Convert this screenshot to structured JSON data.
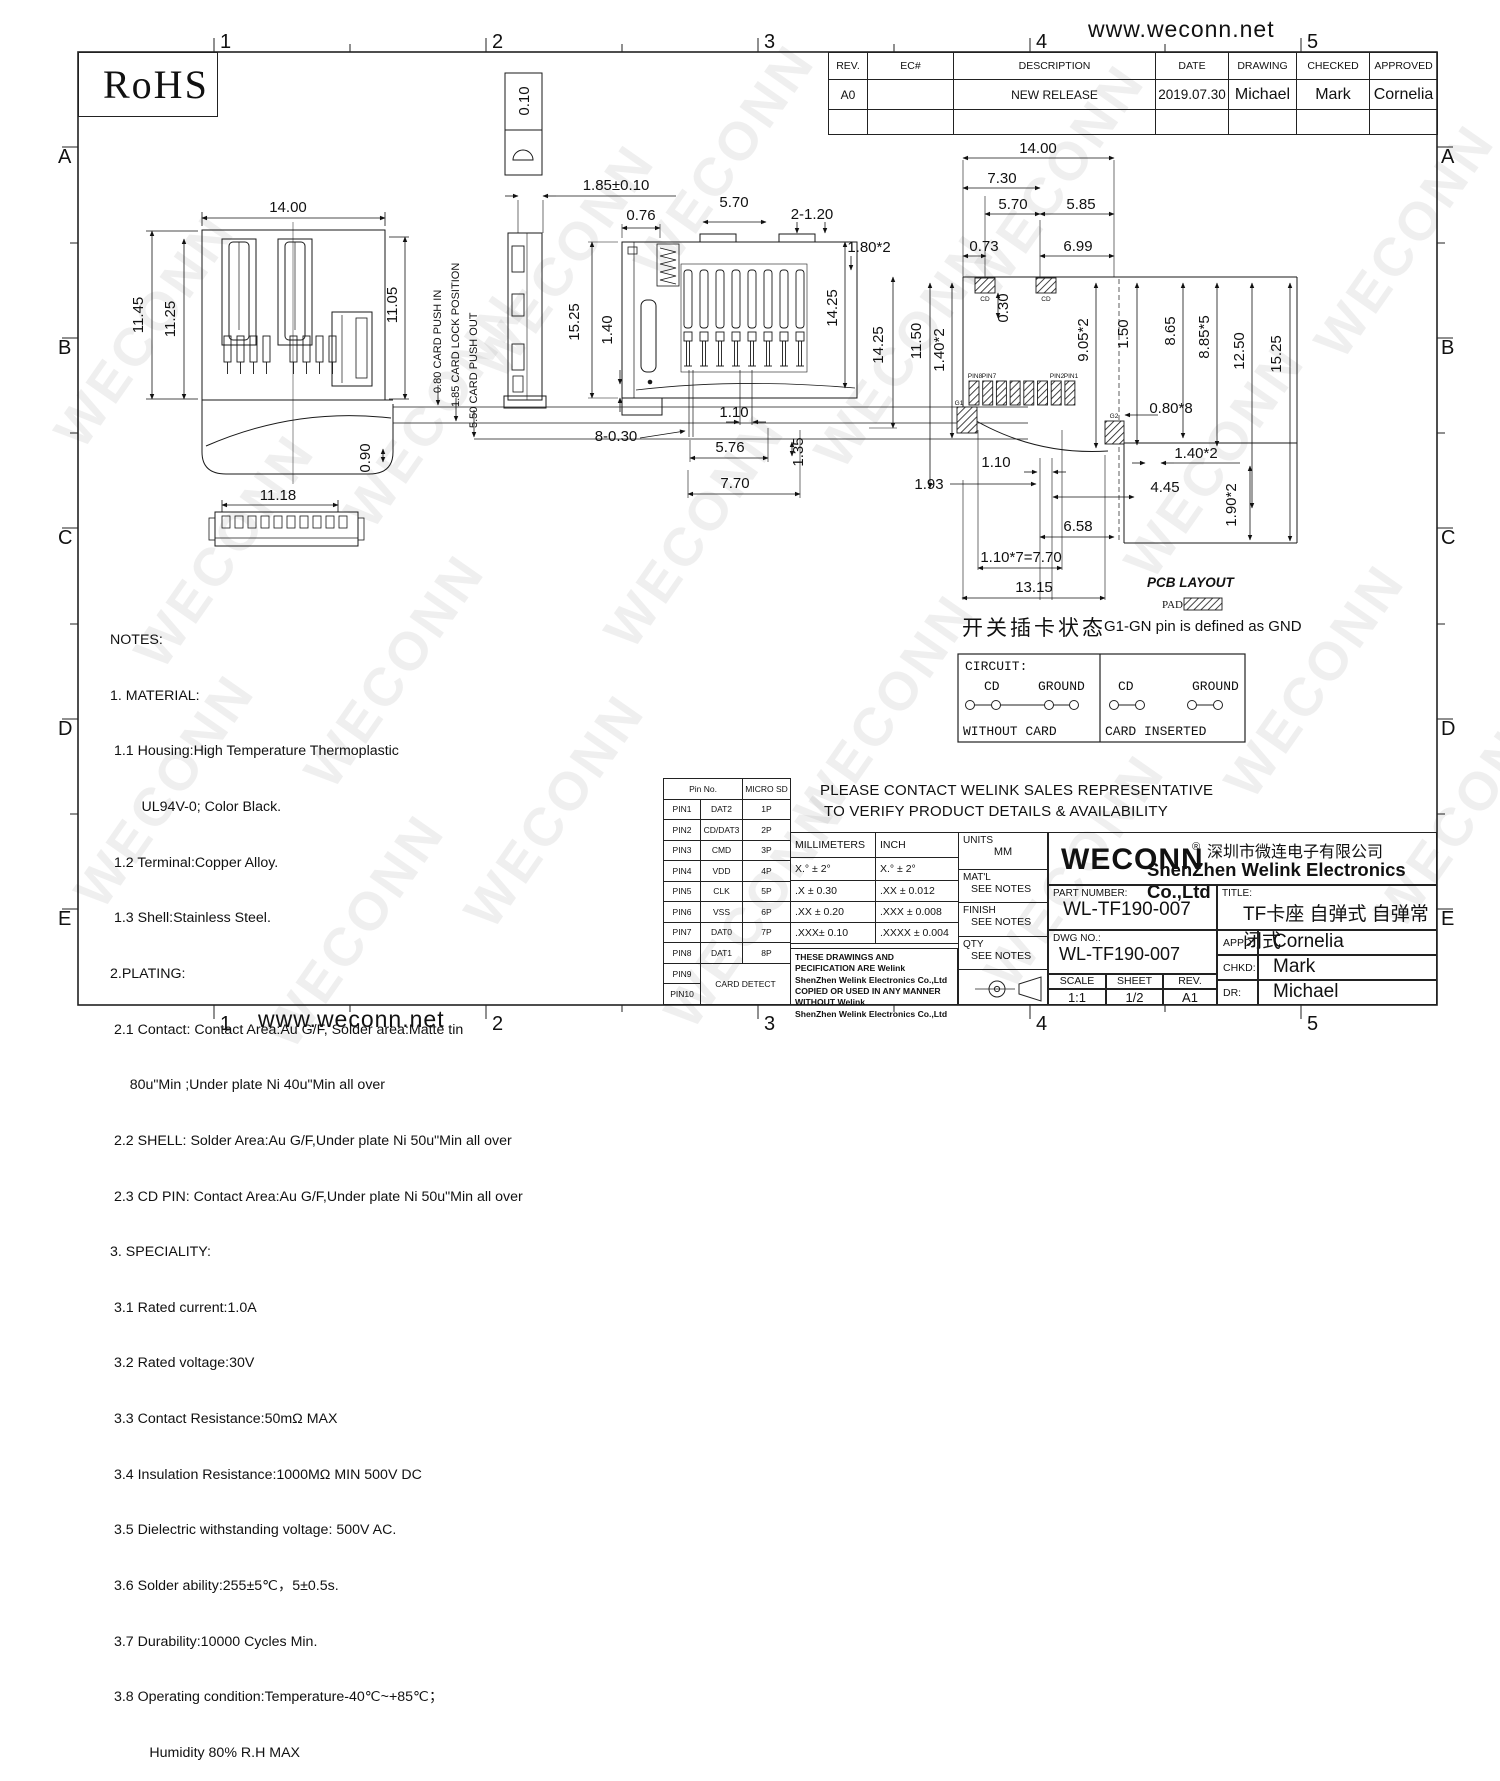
{
  "page": {
    "website_top": "www.weconn.net",
    "website_bottom": "www.weconn.net",
    "watermark": "WECONN"
  },
  "zones": {
    "cols": [
      "1",
      "2",
      "3",
      "4",
      "5"
    ],
    "rows": [
      "A",
      "B",
      "C",
      "D",
      "E"
    ]
  },
  "rohs": {
    "label": "RoHS"
  },
  "revision_table": {
    "headers": [
      "REV.",
      "EC#",
      "DESCRIPTION",
      "DATE",
      "DRAWING",
      "CHECKED",
      "APPROVED"
    ],
    "row": {
      "rev": "A0",
      "ec": "",
      "description": "NEW RELEASE",
      "date": "2019.07.30",
      "drawing": "Michael",
      "checked": "Mark",
      "approved": "Cornelia"
    }
  },
  "dims": {
    "front": {
      "w": "14.00",
      "h1": "11.45",
      "h2": "11.25",
      "h3": "11.05",
      "t": "0.90",
      "bw": "11.18",
      "push_in": "0.80  CARD PUSH IN",
      "lock": "1.85 CARD LOCK POSITION",
      "push_out": "5.50 CARD PUSH OUT"
    },
    "side": {
      "flat": "0.10",
      "pitch": "1.85±0.10"
    },
    "mid": {
      "a": "0.76",
      "b": "5.70",
      "c": "2-1.20",
      "d": "1.80*2",
      "e": "15.25",
      "f": "1.40",
      "g": "14.25",
      "h": "14.25",
      "i": "1.10",
      "j": "8-0.30",
      "k": "5.76",
      "l": "1.35",
      "m": "7.70"
    },
    "pcb": {
      "w": "14.00",
      "a": "7.30",
      "b": "5.70",
      "c": "5.85",
      "d": "0.73",
      "e": "6.99",
      "f": "0.30",
      "g": "11.50",
      "h": "1.40*2",
      "i": "9.05*2",
      "j": "1.50",
      "k": "8.65",
      "l": "8.85*5",
      "m": "12.50",
      "n": "15.25",
      "o": "0.80*8",
      "p": "1.40*2",
      "q": "1.10",
      "r": "1.93",
      "s": "4.45",
      "t": "6.58",
      "u": "1.10*7=7.70",
      "v": "13.15",
      "x": "1.90*2"
    }
  },
  "pcb_view": {
    "cd": "CD",
    "pin8": "PIN8",
    "pin7": "PIN7",
    "pin2": "PIN2",
    "pin1": "PIN1",
    "g1": "G1",
    "g2": "G2",
    "legend_title": "PCB LAYOUT",
    "legend_pad": "PAD"
  },
  "switch_note": {
    "cn": "开关插卡状态",
    "gnd": "G1-GN pin is defined as GND"
  },
  "circuit": {
    "title": "CIRCUIT:",
    "cd": "CD",
    "ground": "GROUND",
    "without": "WITHOUT  CARD",
    "inserted": "CARD  INSERTED"
  },
  "notes": {
    "lines": [
      "NOTES:",
      "1. MATERIAL:",
      " 1.1 Housing:High Temperature Thermoplastic",
      "        UL94V-0; Color Black.",
      " 1.2 Terminal:Copper Alloy.",
      " 1.3 Shell:Stainless Steel.",
      "2.PLATING:",
      " 2.1 Contact: Contact Area:Au G/F, Solder area:Matte tin",
      "     80u\"Min ;Under plate Ni 40u\"Min all over",
      " 2.2 SHELL: Solder Area:Au G/F,Under plate Ni 50u\"Min all over",
      " 2.3 CD PIN: Contact Area:Au G/F,Under plate Ni 50u\"Min all over",
      "3. SPECIALITY:",
      " 3.1 Rated current:1.0A",
      " 3.2 Rated voltage:30V",
      " 3.3 Contact Resistance:50mΩ MAX",
      " 3.4 Insulation Resistance:1000MΩ MIN 500V DC",
      " 3.5 Dielectric withstanding voltage: 500V AC.",
      " 3.6 Solder ability:255±5℃，5±0.5s.",
      " 3.7 Durability:10000 Cycles Min.",
      " 3.8 Operating condition:Temperature-40℃~+85℃；",
      "          Humidity 80% R.H MAX"
    ]
  },
  "pin_table": {
    "header_pin": "Pin No.",
    "header_sd": "MICRO SD",
    "rows": [
      [
        "PIN1",
        "DAT2",
        "1P"
      ],
      [
        "PIN2",
        "CD/DAT3",
        "2P"
      ],
      [
        "PIN3",
        "CMD",
        "3P"
      ],
      [
        "PIN4",
        "VDD",
        "4P"
      ],
      [
        "PIN5",
        "CLK",
        "5P"
      ],
      [
        "PIN6",
        "VSS",
        "6P"
      ],
      [
        "PIN7",
        "DAT0",
        "7P"
      ],
      [
        "PIN8",
        "DAT1",
        "8P"
      ]
    ],
    "pin9": "PIN9",
    "pin10": "PIN10",
    "card_detect": "CARD DETECT"
  },
  "contact_note": {
    "line1": "PLEASE CONTACT WELINK SALES REPRESENTATIVE",
    "line2": "TO VERIFY PRODUCT DETAILS & AVAILABILITY"
  },
  "tolerance": {
    "mm": [
      "MILLIMETERS",
      "X.°  ±  2°",
      ".X    ± 0.30",
      ".XX  ± 0.20",
      ".XXX±  0.10"
    ],
    "inch": [
      "INCH",
      "X.°  ±  2°",
      ".XX    ± 0.012",
      ".XXX  ± 0.008",
      ".XXXX ± 0.004"
    ],
    "legal": [
      "THESE DRAWINGS AND PECIFICATION ARE Welink",
      "ShenZhen Welink Electronics Co.,Ltd",
      "COPIED OR USED IN ANY MANNER WITHOUT Welink",
      "ShenZhen Welink Electronics Co.,Ltd"
    ]
  },
  "info": {
    "units_label": "UNITS",
    "units": "MM",
    "matl_label": "MAT'L",
    "matl": "SEE NOTES",
    "finish_label": "FINISH",
    "finish": "SEE NOTES",
    "qty_label": "QTY",
    "qty": "SEE NOTES"
  },
  "title_block": {
    "logo": "WECONN",
    "reg": "®",
    "company_cn": "深圳市微连电子有限公司",
    "company_en": "ShenZhen Welink Electronics Co.,Ltd",
    "part_label": "PART NUMBER:",
    "part_number": "WL-TF190-007",
    "title_label": "TITLE:",
    "title": "TF卡座 自弹式 自弹常闭式",
    "dwg_label": "DWG NO.:",
    "dwg_no": "WL-TF190-007",
    "scale_label": "SCALE",
    "scale": "1:1",
    "sheet_label": "SHEET",
    "sheet": "1/2",
    "rev_label": "REV.",
    "rev": "A1",
    "appd_label": "APPD:",
    "appd": "Cornelia",
    "chkd_label": "CHKD:",
    "chkd": "Mark",
    "dr_label": "DR:",
    "dr": "Michael"
  }
}
